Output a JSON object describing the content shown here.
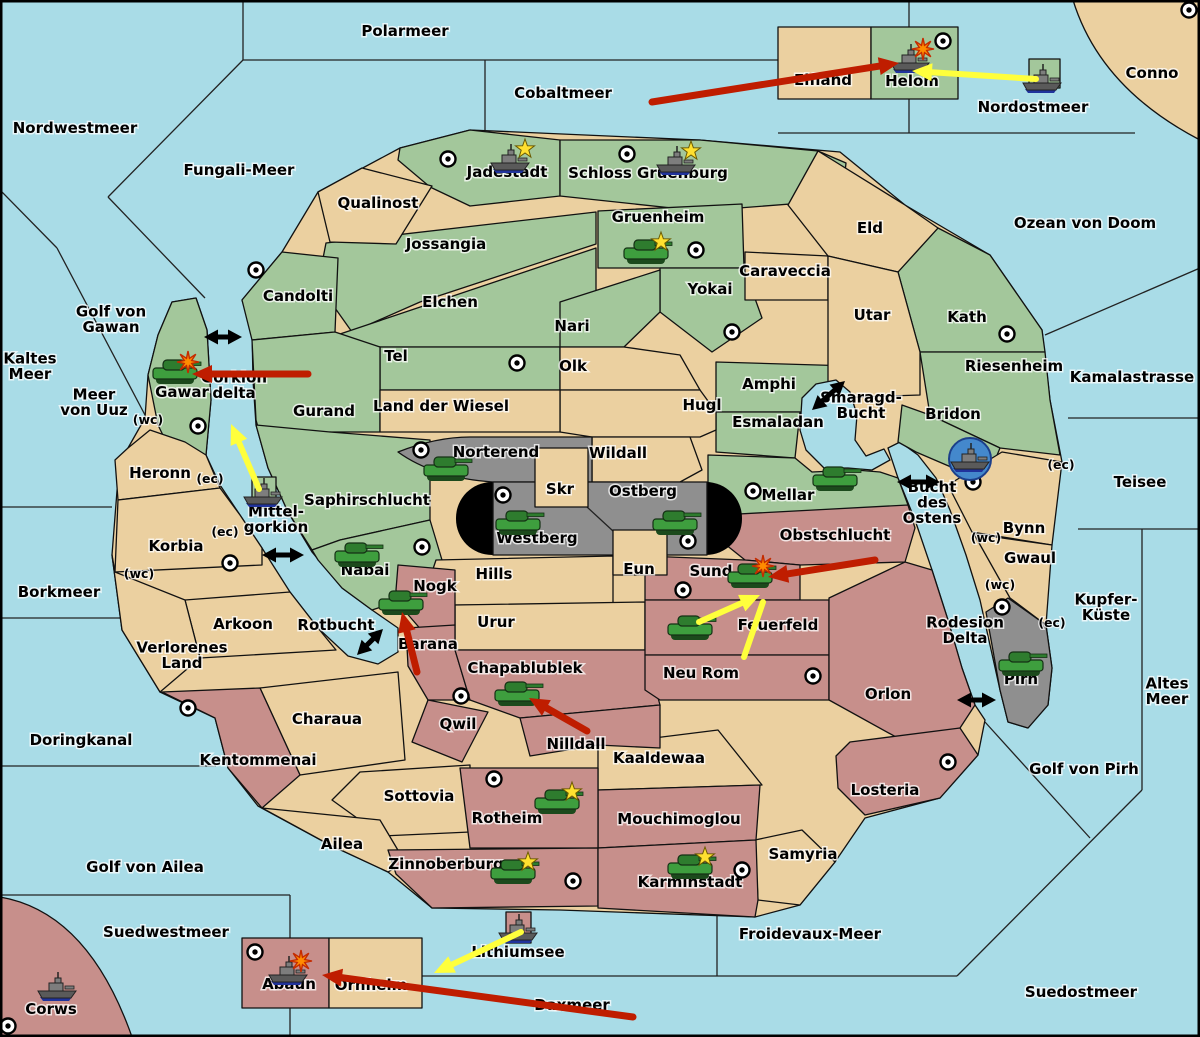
{
  "colors": {
    "sea": "#a9dce7",
    "land_green": "#a3c79b",
    "land_tan": "#ebd0a0",
    "land_red": "#c78f8b",
    "land_gray": "#8f8f8f",
    "arrow_red": "#bf1d00",
    "arrow_yellow": "#ffff3c",
    "arrow_black": "#000000",
    "army_green": "#3e9e3e",
    "fleet_gray": "#5a5a5a",
    "star_yellow": "#ffe030",
    "explosion_orange": "#ff8c00",
    "fleet_circle_blue": "#4488cc"
  },
  "sea_labels": [
    {
      "text": "Polarmeer",
      "x": 405,
      "y": 36
    },
    {
      "text": "Nordwestmeer",
      "x": 75,
      "y": 133
    },
    {
      "text": "Fungali-Meer",
      "x": 239,
      "y": 175
    },
    {
      "text": "Cobaltmeer",
      "x": 563,
      "y": 98
    },
    {
      "text": "Nordostmeer",
      "x": 1033,
      "y": 112
    },
    {
      "text": "Ozean von Doom",
      "x": 1085,
      "y": 228
    },
    {
      "text": "Kamalastrasse",
      "x": 1132,
      "y": 382
    },
    {
      "text": "Teisee",
      "x": 1140,
      "y": 487
    },
    {
      "lines": [
        "Kaltes",
        "Meer"
      ],
      "x": 30,
      "y": 371
    },
    {
      "lines": [
        "Golf von",
        "Gawan"
      ],
      "x": 111,
      "y": 324
    },
    {
      "lines": [
        "Meer",
        "von Uuz"
      ],
      "x": 94,
      "y": 407
    },
    {
      "lines": [
        "Gorkion",
        "delta"
      ],
      "x": 234,
      "y": 390
    },
    {
      "lines": [
        "Mittel-",
        "gorkion"
      ],
      "x": 276,
      "y": 524
    },
    {
      "text": "Borkmeer",
      "x": 59,
      "y": 597
    },
    {
      "text": "Rotbucht",
      "x": 336,
      "y": 630
    },
    {
      "lines": [
        "Smaragd-",
        "Bucht"
      ],
      "x": 861,
      "y": 410
    },
    {
      "lines": [
        "Bucht",
        "des",
        "Ostens"
      ],
      "x": 932,
      "y": 507
    },
    {
      "text": "Doringkanal",
      "x": 81,
      "y": 745
    },
    {
      "text": "Golf von Ailea",
      "x": 145,
      "y": 872
    },
    {
      "text": "Suedwestmeer",
      "x": 166,
      "y": 937
    },
    {
      "text": "Lithiumsee",
      "x": 518,
      "y": 957
    },
    {
      "text": "Daxmeer",
      "x": 572,
      "y": 1010
    },
    {
      "text": "Froidevaux-Meer",
      "x": 810,
      "y": 939
    },
    {
      "text": "Suedostmeer",
      "x": 1081,
      "y": 997
    },
    {
      "text": "Golf von Pirh",
      "x": 1084,
      "y": 774
    },
    {
      "lines": [
        "Altes",
        "Meer"
      ],
      "x": 1167,
      "y": 696
    },
    {
      "lines": [
        "Kupfer-",
        "Küste"
      ],
      "x": 1106,
      "y": 612
    },
    {
      "lines": [
        "Rodesion",
        "Delta"
      ],
      "x": 965,
      "y": 635
    }
  ],
  "land_labels": [
    {
      "text": "Qualinost",
      "x": 378,
      "y": 208
    },
    {
      "text": "Jadestadt",
      "x": 507,
      "y": 177
    },
    {
      "text": "Schloss Gruenburg",
      "x": 648,
      "y": 178
    },
    {
      "text": "Gruenheim",
      "x": 658,
      "y": 222
    },
    {
      "text": "Jossangia",
      "x": 446,
      "y": 249
    },
    {
      "text": "Candolti",
      "x": 298,
      "y": 301
    },
    {
      "text": "Elchen",
      "x": 450,
      "y": 307
    },
    {
      "text": "Nari",
      "x": 572,
      "y": 331
    },
    {
      "text": "Tel",
      "x": 396,
      "y": 361
    },
    {
      "text": "Olk",
      "x": 573,
      "y": 371
    },
    {
      "text": "Yokai",
      "x": 710,
      "y": 294
    },
    {
      "text": "Caraveccia",
      "x": 785,
      "y": 276
    },
    {
      "text": "Eld",
      "x": 870,
      "y": 233
    },
    {
      "text": "Utar",
      "x": 872,
      "y": 320
    },
    {
      "text": "Kath",
      "x": 967,
      "y": 322
    },
    {
      "text": "Riesenheim",
      "x": 1014,
      "y": 371
    },
    {
      "text": "Bridon",
      "x": 953,
      "y": 419
    },
    {
      "text": "Amphi",
      "x": 769,
      "y": 389
    },
    {
      "text": "Esmaladan",
      "x": 778,
      "y": 427
    },
    {
      "text": "Mellar",
      "x": 788,
      "y": 500
    },
    {
      "text": "Gurand",
      "x": 324,
      "y": 416
    },
    {
      "text": "Land der Wiesel",
      "x": 441,
      "y": 411
    },
    {
      "text": "Hugl",
      "x": 702,
      "y": 410
    },
    {
      "text": "Wildall",
      "x": 618,
      "y": 458
    },
    {
      "text": "Norterend",
      "x": 496,
      "y": 457
    },
    {
      "text": "Skr",
      "x": 560,
      "y": 494
    },
    {
      "text": "Ostberg",
      "x": 643,
      "y": 496
    },
    {
      "text": "Westberg",
      "x": 537,
      "y": 543
    },
    {
      "text": "Saphirschlucht",
      "x": 367,
      "y": 505
    },
    {
      "text": "Nabai",
      "x": 365,
      "y": 575
    },
    {
      "text": "Gawar",
      "x": 182,
      "y": 397
    },
    {
      "text": "Heronn",
      "x": 160,
      "y": 478
    },
    {
      "text": "Korbia",
      "x": 176,
      "y": 551
    },
    {
      "text": "Arkoon",
      "x": 243,
      "y": 629
    },
    {
      "lines": [
        "Verlorenes",
        "Land"
      ],
      "x": 182,
      "y": 660
    },
    {
      "text": "Hills",
      "x": 494,
      "y": 579
    },
    {
      "text": "Eun",
      "x": 639,
      "y": 574
    },
    {
      "text": "Urur",
      "x": 496,
      "y": 627
    },
    {
      "text": "Sund",
      "x": 711,
      "y": 576
    },
    {
      "text": "Obstschlucht",
      "x": 835,
      "y": 540
    },
    {
      "text": "Feuerfeld",
      "x": 778,
      "y": 630
    },
    {
      "text": "Neu Rom",
      "x": 701,
      "y": 678
    },
    {
      "text": "Nogk",
      "x": 435,
      "y": 591
    },
    {
      "text": "Barana",
      "x": 428,
      "y": 649
    },
    {
      "text": "Chapablublek",
      "x": 525,
      "y": 673
    },
    {
      "text": "Qwil",
      "x": 458,
      "y": 729
    },
    {
      "text": "Nilldall",
      "x": 576,
      "y": 749
    },
    {
      "text": "Kaaldewaa",
      "x": 659,
      "y": 763
    },
    {
      "text": "Charaua",
      "x": 327,
      "y": 724
    },
    {
      "text": "Kentommenai",
      "x": 258,
      "y": 765
    },
    {
      "text": "Sottovia",
      "x": 419,
      "y": 801
    },
    {
      "text": "Ailea",
      "x": 342,
      "y": 849
    },
    {
      "text": "Rotheim",
      "x": 507,
      "y": 823
    },
    {
      "text": "Mouchimoglou",
      "x": 679,
      "y": 824
    },
    {
      "text": "Zinnoberburg",
      "x": 446,
      "y": 869
    },
    {
      "text": "Karminstadt",
      "x": 690,
      "y": 887
    },
    {
      "text": "Samyria",
      "x": 803,
      "y": 859
    },
    {
      "text": "Losteria",
      "x": 885,
      "y": 795
    },
    {
      "text": "Orlon",
      "x": 888,
      "y": 699
    },
    {
      "text": "Bynn",
      "x": 1024,
      "y": 533
    },
    {
      "text": "Gwaul",
      "x": 1030,
      "y": 563
    },
    {
      "text": "Pirh",
      "x": 1021,
      "y": 684
    },
    {
      "text": "Elfland",
      "x": 823,
      "y": 85
    },
    {
      "text": "Helom",
      "x": 912,
      "y": 86
    },
    {
      "text": "Conno",
      "x": 1152,
      "y": 78
    },
    {
      "text": "Corws",
      "x": 51,
      "y": 1014
    },
    {
      "text": "Abaun",
      "x": 289,
      "y": 989
    },
    {
      "text": "Ornheim",
      "x": 371,
      "y": 990
    }
  ],
  "coast_markers": [
    {
      "text": "(wc)",
      "x": 148,
      "y": 420
    },
    {
      "text": "(ec)",
      "x": 210,
      "y": 479
    },
    {
      "text": "(ec)",
      "x": 225,
      "y": 532
    },
    {
      "text": "(wc)",
      "x": 139,
      "y": 574
    },
    {
      "text": "(ec)",
      "x": 1061,
      "y": 465
    },
    {
      "text": "(wc)",
      "x": 986,
      "y": 538
    },
    {
      "text": "(wc)",
      "x": 1000,
      "y": 585
    },
    {
      "text": "(ec)",
      "x": 1052,
      "y": 623
    }
  ],
  "supply_centers": [
    {
      "x": 448,
      "y": 159
    },
    {
      "x": 627,
      "y": 154
    },
    {
      "x": 696,
      "y": 250
    },
    {
      "x": 256,
      "y": 270
    },
    {
      "x": 517,
      "y": 363
    },
    {
      "x": 732,
      "y": 332
    },
    {
      "x": 1007,
      "y": 334
    },
    {
      "x": 943,
      "y": 41
    },
    {
      "x": 1189,
      "y": 10
    },
    {
      "x": 198,
      "y": 426
    },
    {
      "x": 421,
      "y": 450
    },
    {
      "x": 503,
      "y": 495
    },
    {
      "x": 688,
      "y": 541
    },
    {
      "x": 753,
      "y": 491
    },
    {
      "x": 973,
      "y": 482
    },
    {
      "x": 422,
      "y": 547
    },
    {
      "x": 230,
      "y": 563
    },
    {
      "x": 188,
      "y": 708
    },
    {
      "x": 683,
      "y": 590
    },
    {
      "x": 813,
      "y": 676
    },
    {
      "x": 461,
      "y": 696
    },
    {
      "x": 494,
      "y": 779
    },
    {
      "x": 573,
      "y": 881
    },
    {
      "x": 742,
      "y": 870
    },
    {
      "x": 948,
      "y": 762
    },
    {
      "x": 1002,
      "y": 607
    },
    {
      "x": 255,
      "y": 952
    },
    {
      "x": 8,
      "y": 1026
    }
  ],
  "units": [
    {
      "type": "fleet",
      "x": 510,
      "y": 160,
      "star": true
    },
    {
      "type": "fleet",
      "x": 676,
      "y": 162,
      "star": true
    },
    {
      "type": "fleet",
      "x": 910,
      "y": 60,
      "explosion": true
    },
    {
      "type": "fleet",
      "x": 1042,
      "y": 80
    },
    {
      "type": "fleet",
      "x": 263,
      "y": 494
    },
    {
      "type": "fleet",
      "x": 970,
      "y": 459,
      "circled": true
    },
    {
      "type": "fleet",
      "x": 518,
      "y": 930
    },
    {
      "type": "fleet",
      "x": 57,
      "y": 988
    },
    {
      "type": "fleet",
      "x": 288,
      "y": 972,
      "explosion": true
    },
    {
      "type": "army",
      "x": 646,
      "y": 253,
      "star": true
    },
    {
      "type": "army",
      "x": 175,
      "y": 373,
      "explosion": true
    },
    {
      "type": "army",
      "x": 446,
      "y": 470
    },
    {
      "type": "army",
      "x": 518,
      "y": 524
    },
    {
      "type": "army",
      "x": 675,
      "y": 524
    },
    {
      "type": "army",
      "x": 835,
      "y": 480
    },
    {
      "type": "army",
      "x": 357,
      "y": 556
    },
    {
      "type": "army",
      "x": 401,
      "y": 604
    },
    {
      "type": "army",
      "x": 750,
      "y": 577,
      "explosion": true
    },
    {
      "type": "army",
      "x": 690,
      "y": 629
    },
    {
      "type": "army",
      "x": 517,
      "y": 695
    },
    {
      "type": "army",
      "x": 557,
      "y": 803,
      "star": true
    },
    {
      "type": "army",
      "x": 513,
      "y": 873,
      "star": true
    },
    {
      "type": "army",
      "x": 690,
      "y": 868,
      "star": true
    },
    {
      "type": "army",
      "x": 1021,
      "y": 665
    }
  ],
  "arrows": [
    {
      "color": "black",
      "x1": 204,
      "y1": 337,
      "x2": 242,
      "y2": 337,
      "double": true,
      "w": 5
    },
    {
      "color": "black",
      "x1": 262,
      "y1": 555,
      "x2": 304,
      "y2": 555,
      "double": true,
      "w": 5
    },
    {
      "color": "black",
      "x1": 812,
      "y1": 410,
      "x2": 845,
      "y2": 381,
      "double": true,
      "w": 5
    },
    {
      "color": "black",
      "x1": 897,
      "y1": 482,
      "x2": 940,
      "y2": 482,
      "double": true,
      "w": 5
    },
    {
      "color": "black",
      "x1": 957,
      "y1": 700,
      "x2": 996,
      "y2": 700,
      "double": true,
      "w": 5
    },
    {
      "color": "black",
      "x1": 357,
      "y1": 655,
      "x2": 383,
      "y2": 629,
      "double": true,
      "w": 5
    },
    {
      "color": "red",
      "x1": 652,
      "y1": 102,
      "x2": 899,
      "y2": 63,
      "w": 7
    },
    {
      "color": "red",
      "x1": 308,
      "y1": 374,
      "x2": 192,
      "y2": 374,
      "w": 7
    },
    {
      "color": "red",
      "x1": 875,
      "y1": 560,
      "x2": 768,
      "y2": 577,
      "w": 7
    },
    {
      "color": "red",
      "x1": 587,
      "y1": 731,
      "x2": 529,
      "y2": 698,
      "w": 7
    },
    {
      "color": "red",
      "x1": 417,
      "y1": 672,
      "x2": 402,
      "y2": 612,
      "w": 7
    },
    {
      "color": "red",
      "x1": 633,
      "y1": 1017,
      "x2": 322,
      "y2": 975,
      "w": 7
    },
    {
      "color": "yellow",
      "x1": 1036,
      "y1": 79,
      "x2": 912,
      "y2": 71,
      "w": 6
    },
    {
      "color": "yellow",
      "x1": 259,
      "y1": 489,
      "x2": 231,
      "y2": 424,
      "w": 6
    },
    {
      "color": "yellow",
      "x1": 699,
      "y1": 622,
      "x2": 760,
      "y2": 595,
      "w": 6
    },
    {
      "color": "yellow",
      "x1": 744,
      "y1": 657,
      "x2": 763,
      "y2": 602,
      "w": 6,
      "head": false
    },
    {
      "color": "yellow",
      "x1": 521,
      "y1": 932,
      "x2": 434,
      "y2": 973,
      "w": 6
    }
  ]
}
